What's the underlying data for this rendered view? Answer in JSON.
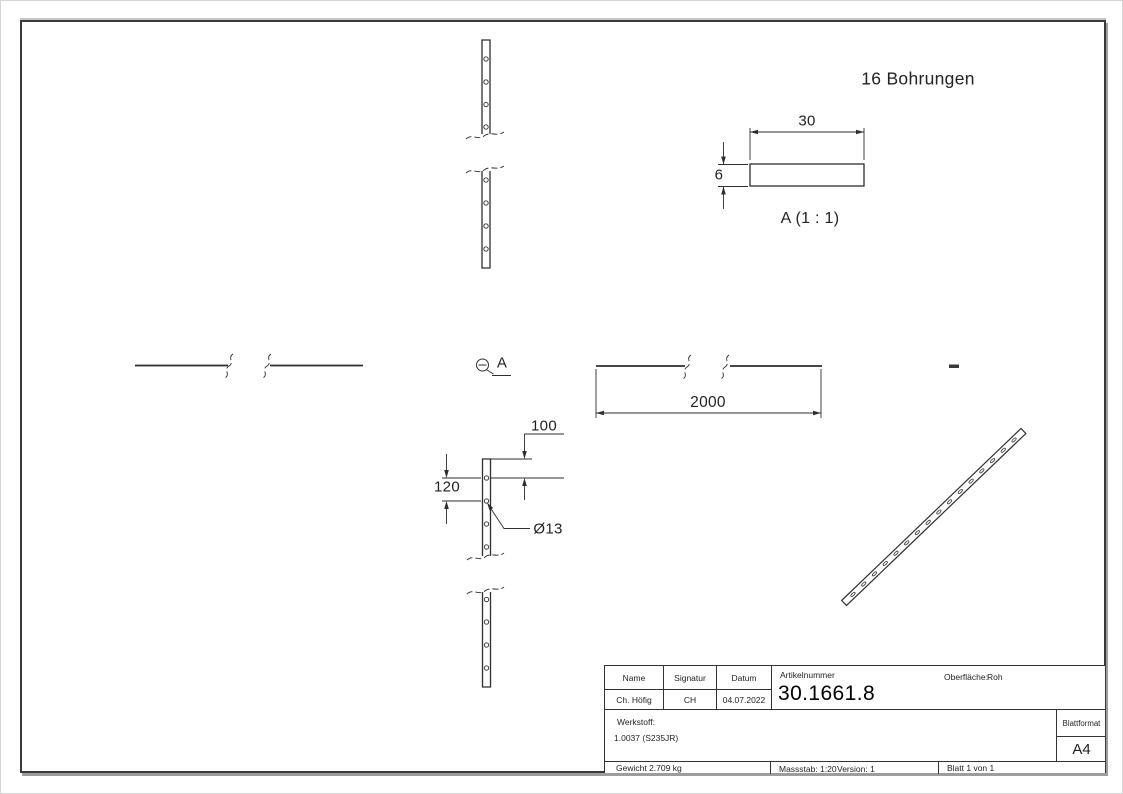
{
  "sheet": {
    "note": "16 Bohrungen",
    "detail_label": "A (1 : 1)",
    "callout_label": "A",
    "dims": {
      "length": "2000",
      "end_offset": "100",
      "pitch": "120",
      "hole_dia": "Ø13",
      "profile_width": "30",
      "profile_height": "6"
    }
  },
  "title_block": {
    "col_name": "Name",
    "col_signature": "Signatur",
    "col_date": "Datum",
    "article_label": "Artikelnummer",
    "article_number": "30.1661.8",
    "surface_label": "Oberfläche:",
    "surface_value": "Roh",
    "name_value": "Ch. Höfig",
    "signature_value": "CH",
    "date_value": "04.07.2022",
    "material_label": "Werkstoff:",
    "material_value": "1.0037 (S235JR)",
    "format_label": "Blattformat",
    "format_value": "A4",
    "weight": "Gewicht 2.709 kg",
    "scale": "Massstab: 1:20",
    "version": "Version: 1",
    "sheet_count": "Blatt 1 von 1"
  }
}
